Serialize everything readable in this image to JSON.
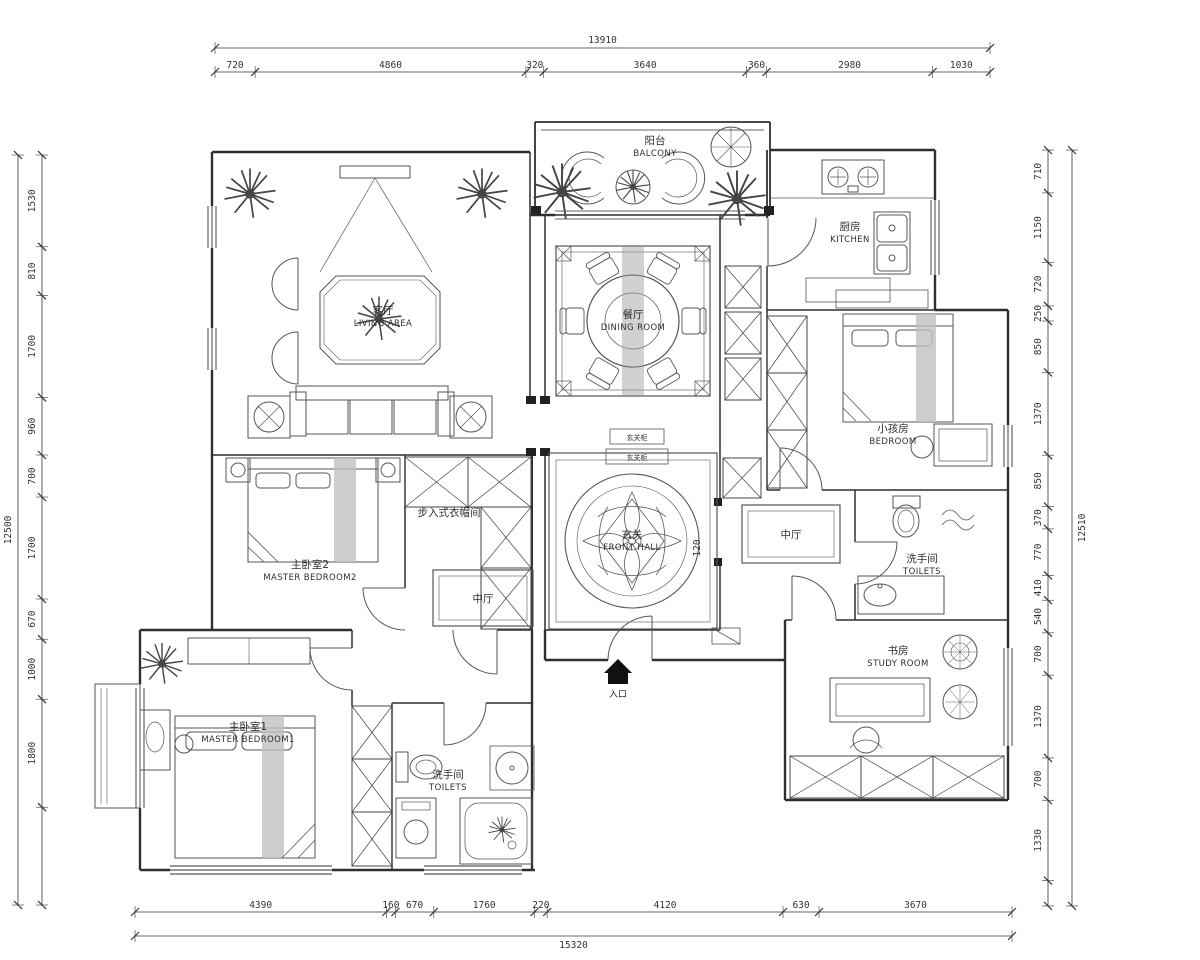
{
  "dimensions": {
    "top": {
      "total": "13910",
      "segments": [
        "720",
        "4860",
        "320",
        "3640",
        "360",
        "2980",
        "1030"
      ]
    },
    "bottom": {
      "total": "15320",
      "segments": [
        "4390",
        "160",
        "670",
        "1760",
        "220",
        "4120",
        "630",
        "3670"
      ]
    },
    "left": {
      "total": "12500",
      "segments": [
        "1530",
        "810",
        "1700",
        "960",
        "700",
        "1700",
        "670",
        "1000",
        "1800"
      ]
    },
    "right": {
      "total": "12510",
      "segments": [
        "710",
        "1150",
        "720",
        "250",
        "850",
        "1370",
        "850",
        "370",
        "770",
        "410",
        "540",
        "700",
        "1370",
        "700",
        "1330"
      ]
    }
  },
  "rooms": {
    "living": {
      "cn": "客厅",
      "en": "LIVING AREA"
    },
    "balcony": {
      "cn": "阳台",
      "en": "BALCONY"
    },
    "dining": {
      "cn": "餐厅",
      "en": "DINING ROOM"
    },
    "kitchen": {
      "cn": "厨房",
      "en": "KITCHEN"
    },
    "child_bedroom": {
      "cn": "小孩房",
      "en": "BEDROOM"
    },
    "master_bedroom2": {
      "cn": "主卧室2",
      "en": "MASTER BEDROOM2"
    },
    "front_hall": {
      "cn": "玄关",
      "en": "FRONT HALL"
    },
    "hall_mid_left": {
      "cn": "中厅"
    },
    "hall_mid_right": {
      "cn": "中厅"
    },
    "toilets_right": {
      "cn": "洗手间",
      "en": "TOILETS"
    },
    "study": {
      "cn": "书房",
      "en": "STUDY ROOM"
    },
    "master_bedroom1": {
      "cn": "主卧室1",
      "en": "MASTER BEDROOM1"
    },
    "toilets_bottom": {
      "cn": "洗手间",
      "en": "TOILETS"
    },
    "closet": {
      "cn": "步入式衣帽间"
    },
    "entry": {
      "cn": "入口"
    }
  },
  "annotations": {
    "hall_dim": "120",
    "cabinet_callout_1": "玄关柜",
    "cabinet_callout_2": "玄关柜"
  },
  "colors": {
    "line": "#2f2f2f",
    "bg": "#ffffff",
    "runner": "#c0c0c0"
  }
}
